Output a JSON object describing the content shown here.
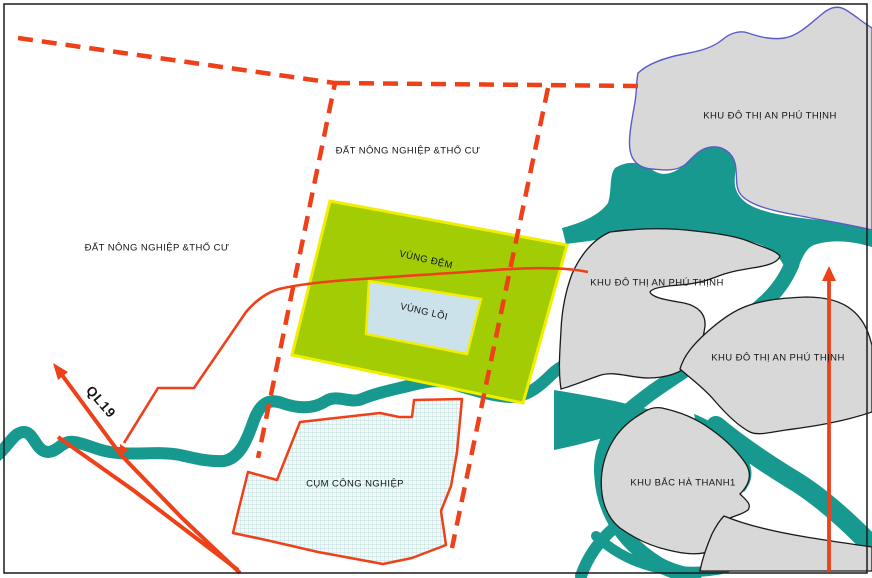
{
  "map": {
    "type": "land-use planning map",
    "labels": {
      "agri_left": "ĐẤT NÔNG NGHIỆP &THỔ CƯ",
      "agri_top": "ĐẤT NÔNG NGHIỆP &THỔ CƯ",
      "buffer_zone": "VÙNG ĐỆM",
      "core_zone": "VÙNG LÕI",
      "industrial_cluster": "CỤM CÔNG NGHIỆP",
      "urban_area_1": "KHU ĐÔ THỊ AN PHÚ THỊNH",
      "urban_area_2": "KHU ĐÔ THỊ AN PHÚ THỊNH",
      "urban_area_3": "KHU ĐÔ THỊ AN PHÚ THỊNH",
      "north_ha_thanh": "KHU BẮC HÀ THANH1",
      "highway": "QL19"
    },
    "colors": {
      "background": "#FFFFFF",
      "frame": "#1A1A1A",
      "water": "#17998F",
      "buffer_fill": "#A2CC04",
      "zone_border_yellow": "#F2EE00",
      "core_fill": "#CBE2EA",
      "urban_fill": "#D8D8D8",
      "urban_outline_top": "#5B5BC8",
      "urban_outline": "#1A1A1A",
      "road_and_boundary_red": "#EE4019",
      "hatch_line": "#ABD6D4",
      "hatch_fill": "#F3FAFA"
    }
  }
}
